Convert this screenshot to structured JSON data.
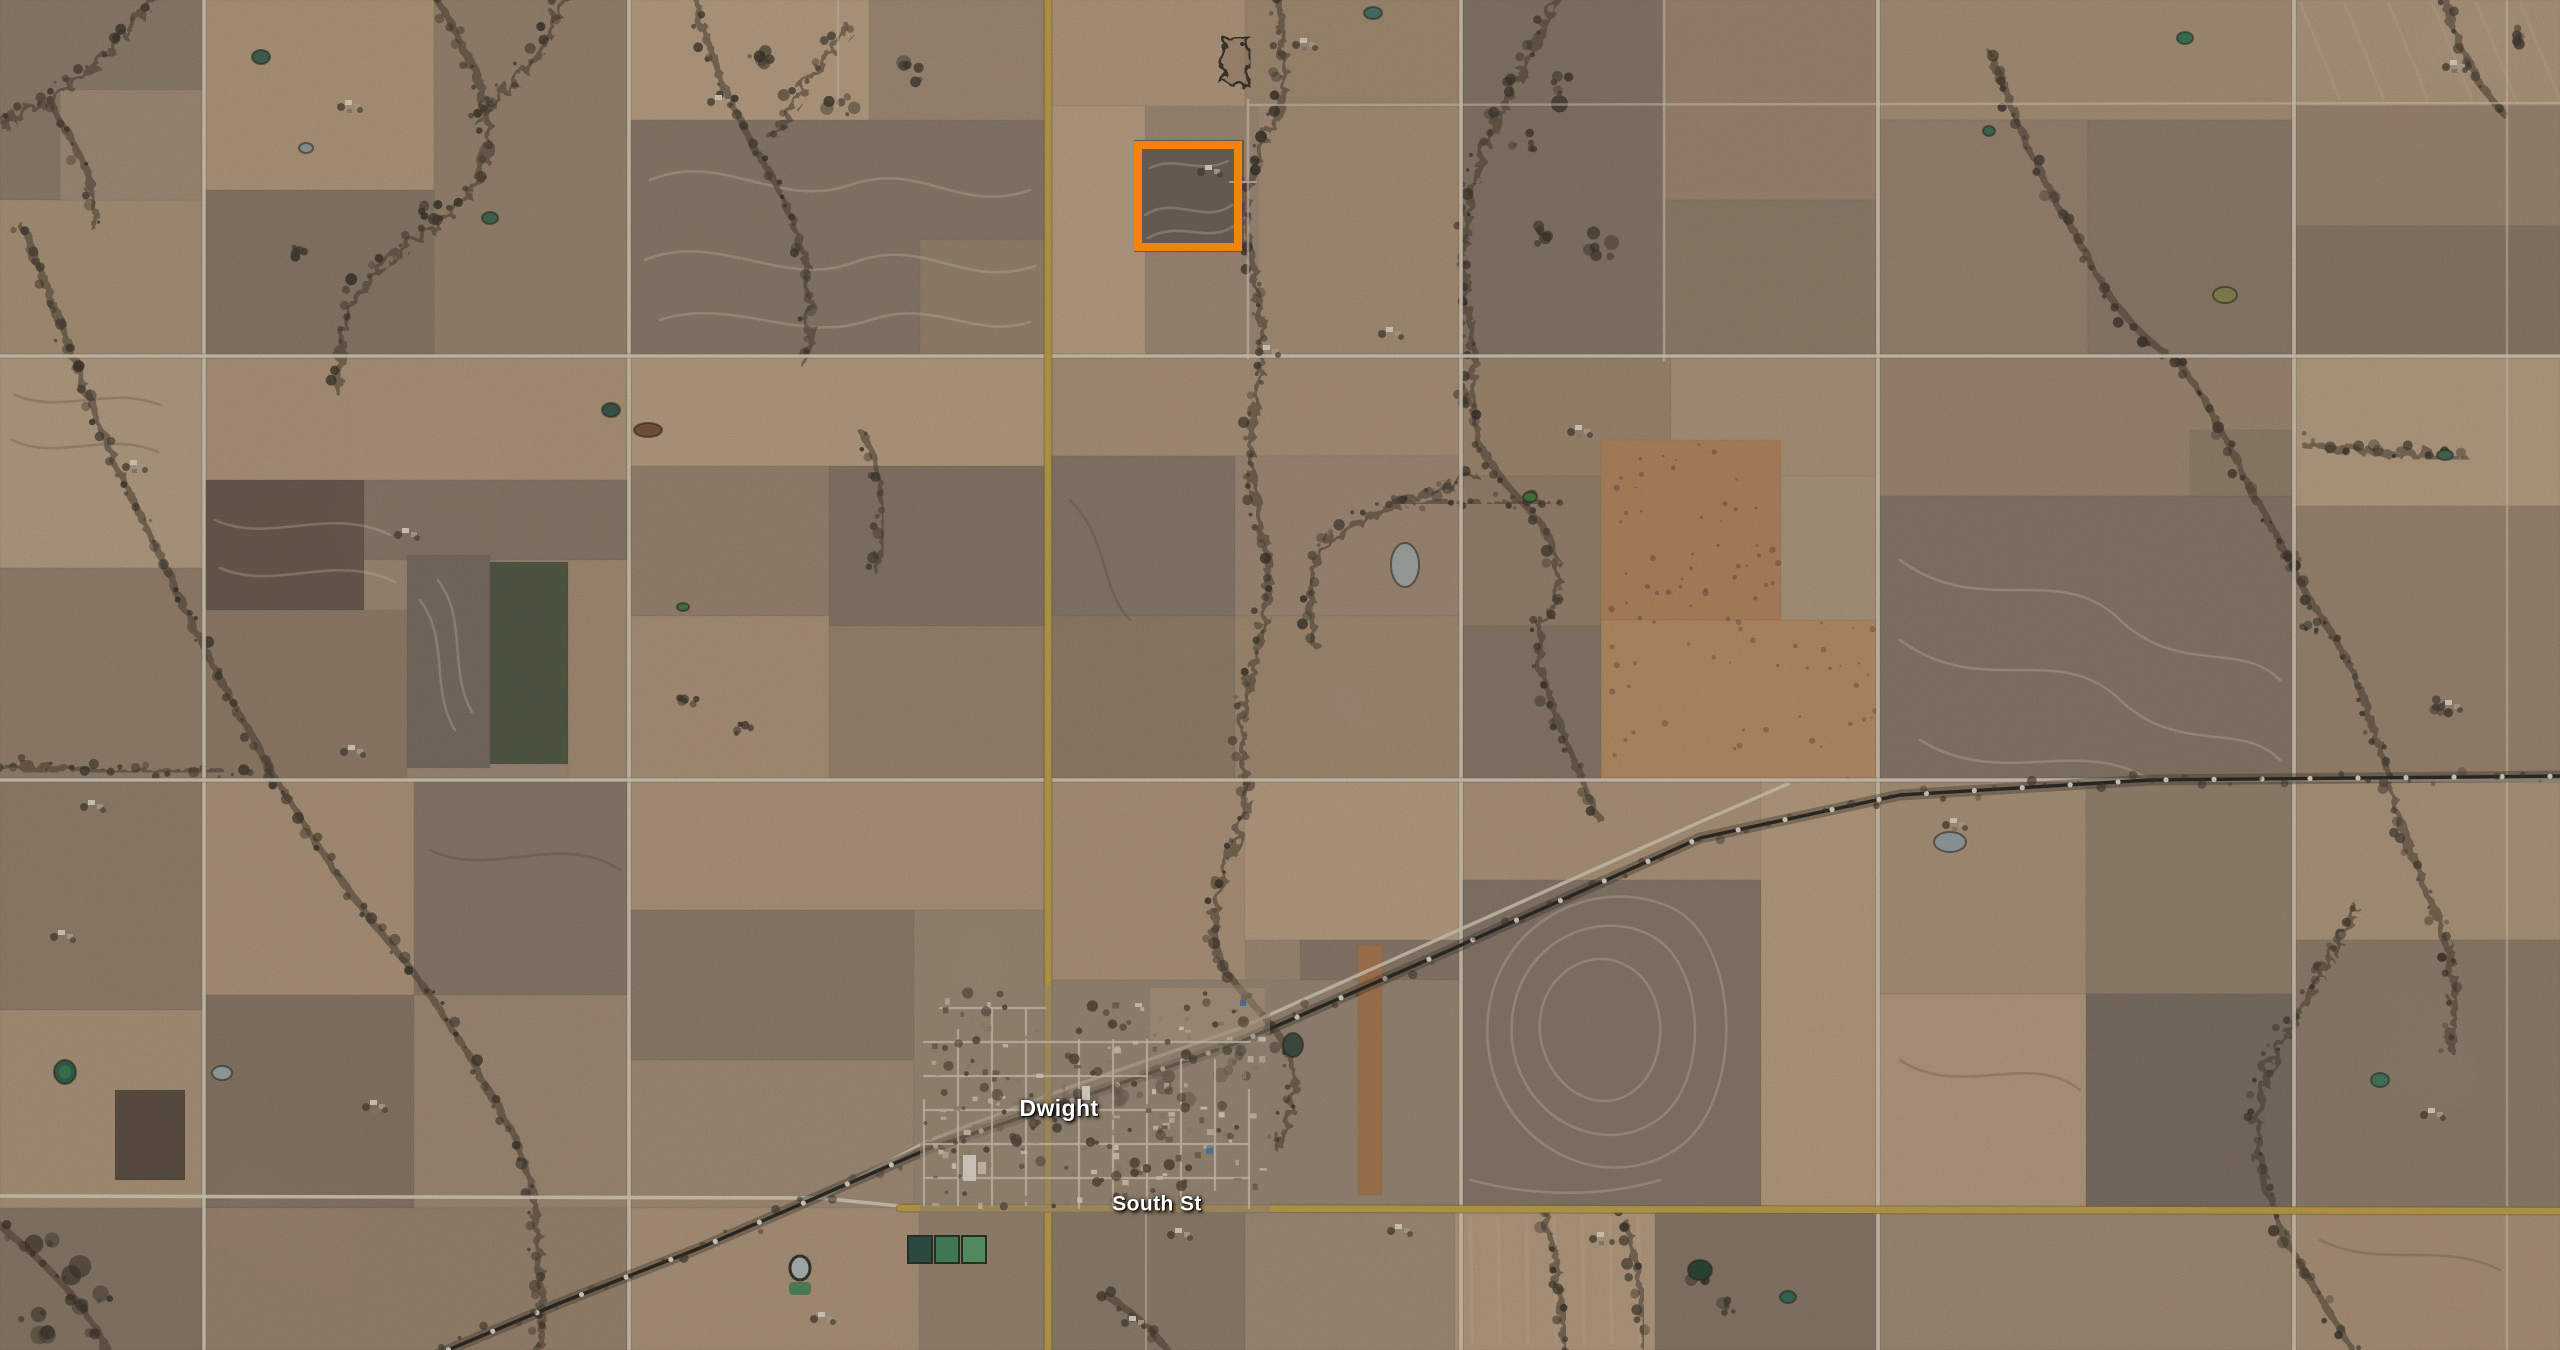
{
  "view": {
    "type": "satellite-map",
    "description": "Aerial imagery of farmland sections around a small town"
  },
  "map_labels": {
    "town": "Dwight",
    "street": "South St"
  },
  "highlight": {
    "x": 1138,
    "y": 145,
    "width": 100,
    "height": 102,
    "stroke_width": 8,
    "color": "#f2830f"
  },
  "colors": {
    "terrain_base": "#a6907c",
    "road_primary": "#c9a845",
    "road_primary_casing": "#7d6a2e",
    "road_minor": "#e3dac8",
    "railroad": "#211d18",
    "railroad_marker": "#f3efe6",
    "label_text": "#ffffff"
  }
}
